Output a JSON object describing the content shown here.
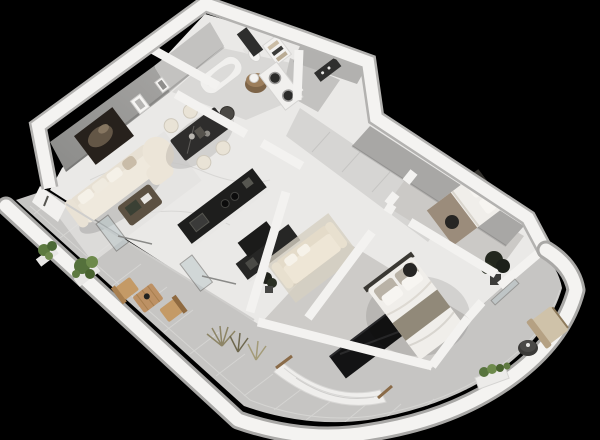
{
  "scene": {
    "description": "3D isometric render of a furnished one-bedroom-plus apartment floor plan with wrap-around curved terrace, shown on a black background",
    "type": "architectural-3d-floor-plan-render"
  },
  "palette": {
    "background": "#000000",
    "wall_top": "#f4f3f1",
    "wall_outer_edge": "#b3b2b0",
    "wall_face_dark": "#969694",
    "wall_face_bath": "#c3c2c0",
    "wall_face_corridor": "#a8a7a5",
    "wall_face_entry": "#b2b1af",
    "floor_marble": "#eae9e7",
    "floor_bath": "#d9d8d6",
    "floor_entry": "#c3c2c0",
    "floor_corridor": "#d6d5d3",
    "floor_carpet_bedroom": "#cbc9c6",
    "floor_carpet_master": "#cdcbc8",
    "floor_tile_terrace": "#c6c5c3",
    "grout_line": "#d8d7d5",
    "accent_artwork": "#27211c",
    "sofa_cream": "#efe9dd",
    "guest_sofa_cream": "#eee6d6",
    "dining_table_stone": "#2e2d2c",
    "chair_cream": "#e9e3d6",
    "kitchen_counter_dark": "#1e1e1d",
    "kitchen_counter_dark2": "#262625",
    "cabinet_beige": "#d9ccb5",
    "coffee_table_wood": "#5c5142",
    "vanity_wood": "#9c7e5c",
    "appliance_white": "#f1f0ee",
    "bed_linen": "#f0eeea",
    "blanket_taupe": "#918979",
    "blanket_bed2": "#9b8c7b",
    "wardrobe_gloss": "#131314",
    "pouf_dark": "#262523",
    "plant_green": "#5d7a40",
    "plant_dark_foliage": "#23271e",
    "grass_olive": "#8d8566",
    "terrace_wood": "#c49a66",
    "hammock_fabric": "#efeeec",
    "lounge_cushion": "#cfc2a9",
    "glass_tint": "#b9c6c9",
    "shadow": "rgba(0,0,0,0.13)"
  },
  "rooms": [
    {
      "id": "living-room",
      "furniture": [
        "accent-wall-artwork",
        "gallery-frame",
        "gallery-frame",
        "corner-sofa",
        "ottoman",
        "coffee-table",
        "area-rug"
      ]
    },
    {
      "id": "dining-area",
      "furniture": [
        "stone-dining-table",
        "dining-chair",
        "dining-chair",
        "dining-chair",
        "dining-chair",
        "head-chair"
      ]
    },
    {
      "id": "kitchen",
      "furniture": [
        "island-counter",
        "wall-counter",
        "beige-cabinet"
      ]
    },
    {
      "id": "bathroom",
      "furniture": [
        "bathtub",
        "toilet",
        "mirror",
        "round-wood-vanity",
        "towel-shelf"
      ]
    },
    {
      "id": "laundry-nook",
      "furniture": [
        "stacked-washer-dryer"
      ]
    },
    {
      "id": "entry-hall",
      "furniture": [
        "electrical-panel",
        "door-step"
      ]
    },
    {
      "id": "hallway",
      "furniture": []
    },
    {
      "id": "guest-room",
      "furniture": [
        "sofa-daybed",
        "media-unit",
        "area-rug",
        "potted-plant"
      ]
    },
    {
      "id": "second-bedroom",
      "furniture": [
        "double-bed",
        "pouf"
      ]
    },
    {
      "id": "master-bedroom",
      "furniture": [
        "double-bed",
        "stool",
        "glossy-wardrobe",
        "potted-plant"
      ]
    },
    {
      "id": "terrace",
      "furniture": [
        "planter",
        "planter",
        "wooden-chair",
        "bistro-table",
        "wooden-chair",
        "ornamental-grass",
        "ornamental-grass",
        "glass-door-panel",
        "glass-door-panel",
        "hammock",
        "lounge-chair",
        "side-table",
        "planter-box"
      ]
    }
  ]
}
